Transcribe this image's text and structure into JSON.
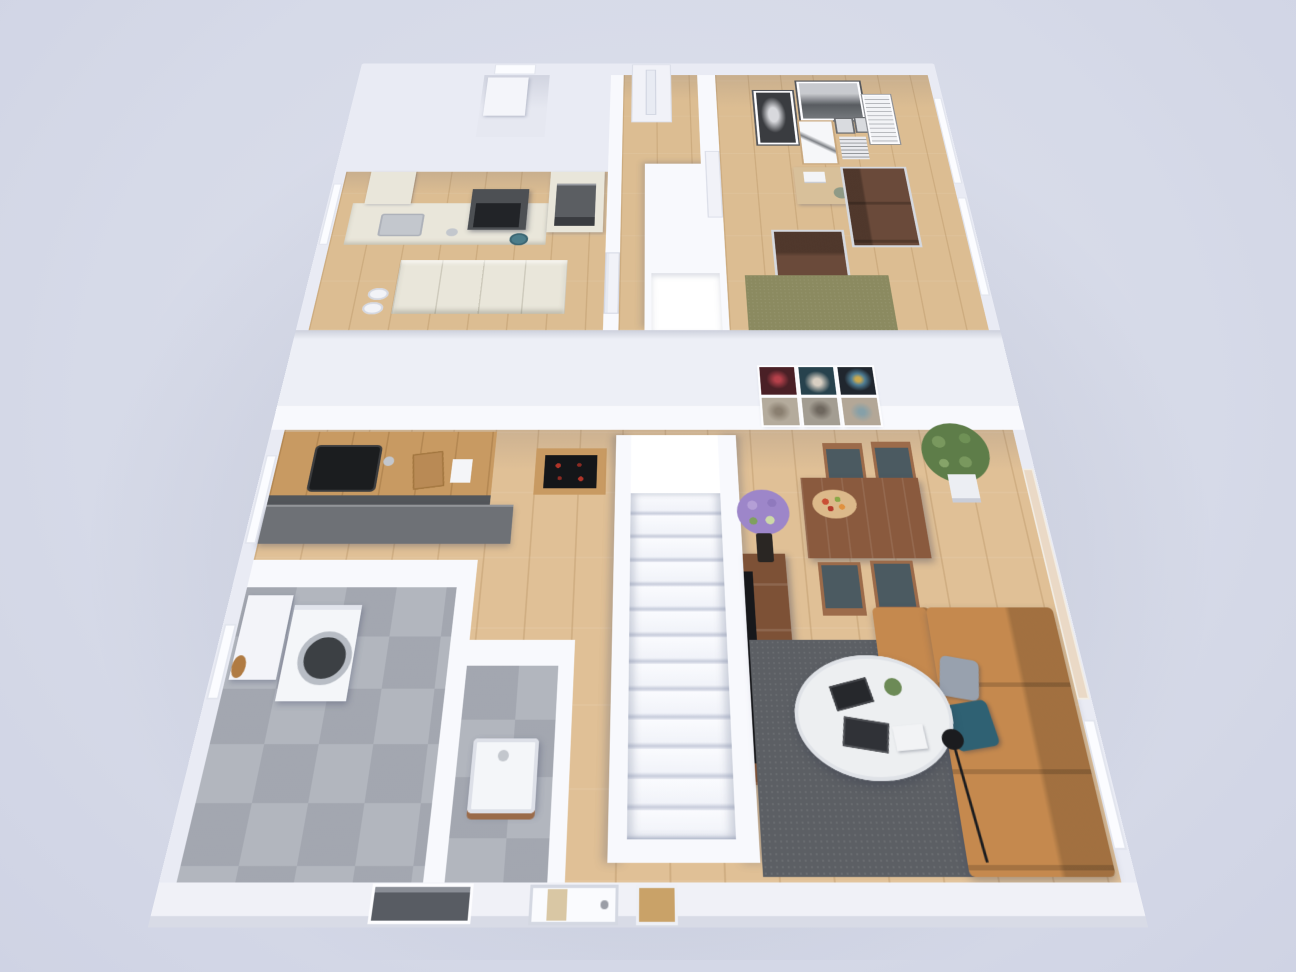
{
  "scene": {
    "title": "3d-floor-plan-render",
    "background": "#d8dbe8"
  },
  "colors": {
    "wall": "#e9ebf4",
    "wall_bright": "#f8f9fd",
    "wall_shade": "#d7dae6",
    "gap_band": "#edeff6",
    "wood": "#e0c096",
    "wood_upper": "#dcbd92",
    "tile": "#b2b6be",
    "cream": "#e9e6da",
    "hood": "#4d5054",
    "oven": "#5b5e62",
    "steel": "#c3c7cd",
    "sink_black": "#1b1d1f",
    "counter_wood": "#c89a62",
    "cabinet_dark": "#53565a",
    "half_wall": "#6e7176",
    "stair": "#f6f7fb",
    "table": "#8a5a3e",
    "chair_wood": "#9c6b4a",
    "chair_seat": "#4b5a61",
    "console": "#7d5136",
    "tv": "#17181b",
    "rug_dark": "#5c5f64",
    "rug_olive": "#8b8a60",
    "sofa_tan": "#c5894e",
    "sofa_brown": "#6a4a3a",
    "chrome": "#d5d8de",
    "pillow_gray": "#98a1ae",
    "pillow_teal": "#2f6173",
    "coffee_table": "#edeff1",
    "lamp": "#1b1c1f",
    "washer": "#f4f6f9",
    "washer_door": "#3c4044",
    "vanity": "#f4f6f9",
    "vanity_wood": "#9a6b4a",
    "plant": "#5e7d49",
    "flowers": "#9d86c9",
    "desk": "#d8c09a",
    "glass_warm": "#ead9c6",
    "door_glass": "#d9c7a4",
    "cellar": "#585c63",
    "fruit_red": "#c94f35",
    "fruit_orange": "#e0913f",
    "fruit_green": "#8aa848",
    "painting_1": "#4a2026",
    "painting_2": "#27424d",
    "painting_3": "#20262e",
    "painting_4": "#b4ab9c",
    "painting_5": "#a39d92",
    "painting_6": "#b3a797",
    "photo_dark": "#3a3c40",
    "photo_mid": "#8e9196"
  },
  "floors": {
    "upper": {
      "label": "upper floor",
      "rooms": [
        {
          "name": "kitchen",
          "furniture": [
            "cream-cabinet-run",
            "range-hood",
            "cooktop",
            "oven-column",
            "steel-sink",
            "kettle",
            "drawer-counter",
            "pet-bowls"
          ]
        },
        {
          "name": "storage-room",
          "furniture": [
            "white-closet",
            "window"
          ]
        },
        {
          "name": "hallway",
          "furniture": [
            "entry-door",
            "stair-void",
            "interior-doors"
          ]
        },
        {
          "name": "living-room",
          "furniture": [
            "gallery-wall",
            "wood-desk",
            "leather-sofa",
            "leather-armchair",
            "olive-rug",
            "windows"
          ]
        }
      ]
    },
    "ground": {
      "label": "ground floor",
      "rooms": [
        {
          "name": "open-kitchen",
          "furniture": [
            "wood-counter-with-black-sink",
            "dark-half-wall",
            "cooktop-counter"
          ]
        },
        {
          "name": "dining-area",
          "furniture": [
            "six-painting-grid",
            "walnut-dining-table",
            "four-chairs",
            "fruit-bowl",
            "potted-plant"
          ]
        },
        {
          "name": "staircase",
          "furniture": [
            "white-treads",
            "landing"
          ]
        },
        {
          "name": "living-area",
          "furniture": [
            "tv-sideboard",
            "flat-tv",
            "flower-vase",
            "dark-gray-rug",
            "tan-corner-sofa",
            "two-pillows",
            "round-coffee-table",
            "magazines",
            "floor-lamp"
          ]
        },
        {
          "name": "laundry-room",
          "furniture": [
            "washing-machine",
            "white-cabinet",
            "window-with-decor"
          ]
        },
        {
          "name": "wc",
          "furniture": [
            "vanity-sink"
          ]
        },
        {
          "name": "hallway",
          "furniture": [
            "front-door",
            "wood-sidelight",
            "cellar-window"
          ]
        }
      ]
    }
  }
}
